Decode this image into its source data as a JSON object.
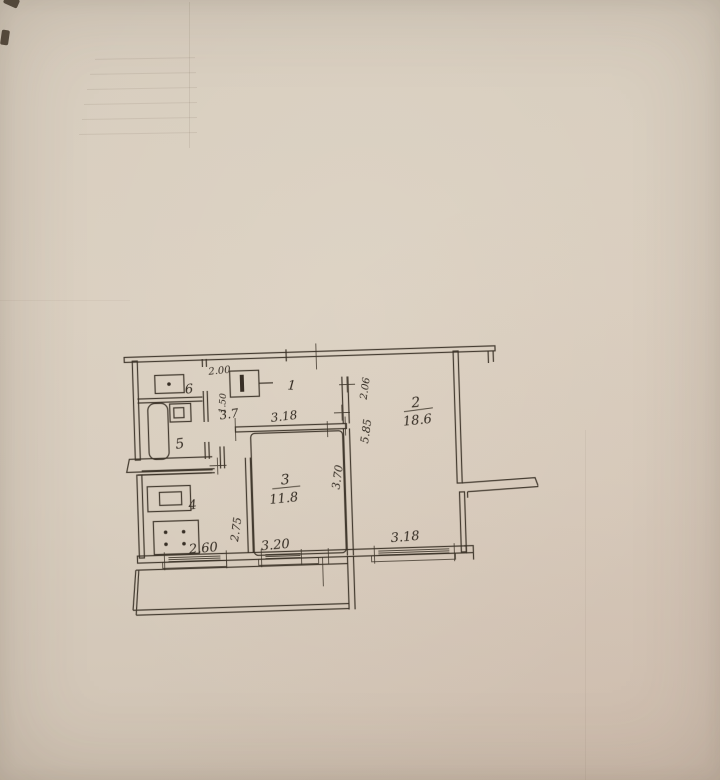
{
  "colors": {
    "paper": "#d9cfc0",
    "ink": "#352c22"
  },
  "plan": {
    "rooms": {
      "hall": {
        "number": "1"
      },
      "living": {
        "number": "2",
        "area": "18.6"
      },
      "bedroom": {
        "number": "3",
        "area": "11.8"
      },
      "kitchen": {
        "number": "4"
      },
      "bath": {
        "number": "5"
      },
      "toilet": {
        "number": "6"
      }
    },
    "dims": {
      "closet_width": "2.00",
      "closet_depth": "1.50",
      "corridor_area": "3.7",
      "hall_width": "3.18",
      "hall_depth": "2.06",
      "living_depth": "5.85",
      "bedroom_depth": "3.70",
      "kitchen_depth": "2.75",
      "kitchen_width": "2.60",
      "bedroom_width": "3.20",
      "living_width": "3.18"
    }
  }
}
